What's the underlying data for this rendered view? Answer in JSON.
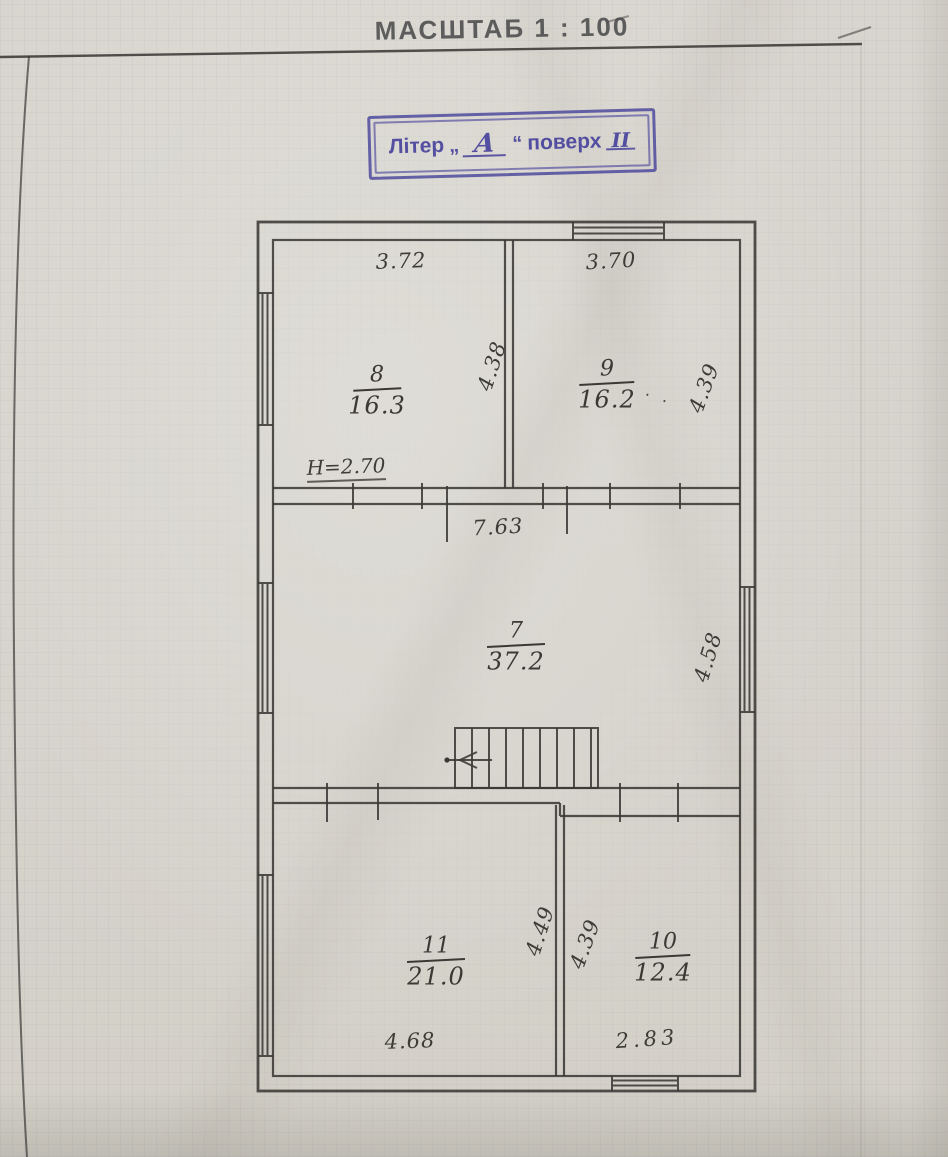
{
  "page": {
    "title": "МАСШТАБ 1 : 100"
  },
  "stamp": {
    "label_liter": "Літер",
    "quote_open": "„",
    "liter_value": "А",
    "quote_close": "“",
    "label_floor": "поверх",
    "floor_value": "ІІ",
    "ink_color": "#4e4a9e"
  },
  "plan": {
    "line_color": "#3b3936",
    "ink_color": "#3f3d38",
    "rooms": [
      {
        "number": "8",
        "area": "16.3"
      },
      {
        "number": "9",
        "area": "16.2"
      },
      {
        "number": "7",
        "area": "37.2"
      },
      {
        "number": "11",
        "area": "21.0"
      },
      {
        "number": "10",
        "area": "12.4"
      }
    ],
    "height_note": "H=2.70",
    "dimensions": {
      "room8_width": "3.72",
      "room9_width": "3.70",
      "room8_depth": "4.38",
      "room9_depth": "4.39",
      "room7_width": "7.63",
      "room7_depth": "4.58",
      "room11_depth": "4.49",
      "room10_depth": "4.39",
      "room11_width": "4.68",
      "room10_width": "2.83"
    },
    "ink_dots": "∙ ∙"
  }
}
